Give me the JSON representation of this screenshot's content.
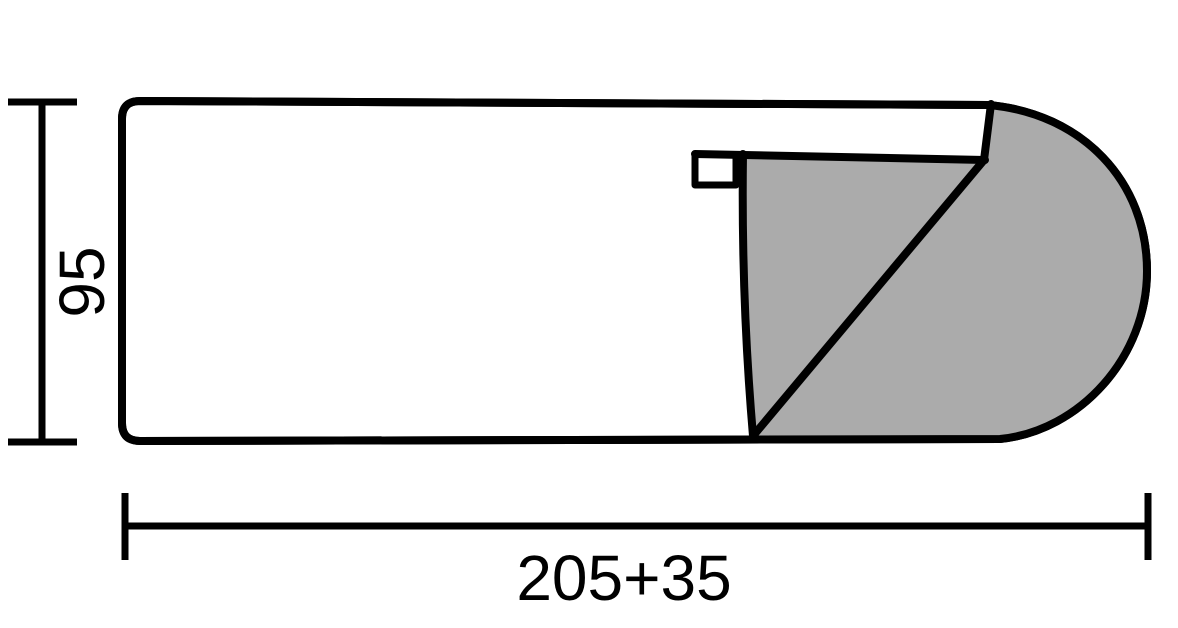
{
  "diagram": {
    "title": "sleeping-bag-dimension-drawing",
    "dimensions": {
      "height_label": "95",
      "length_label": "205+35"
    },
    "colors": {
      "line": "#000000",
      "flap_fill": "#ABABAB",
      "background": "#FFFFFF"
    }
  }
}
